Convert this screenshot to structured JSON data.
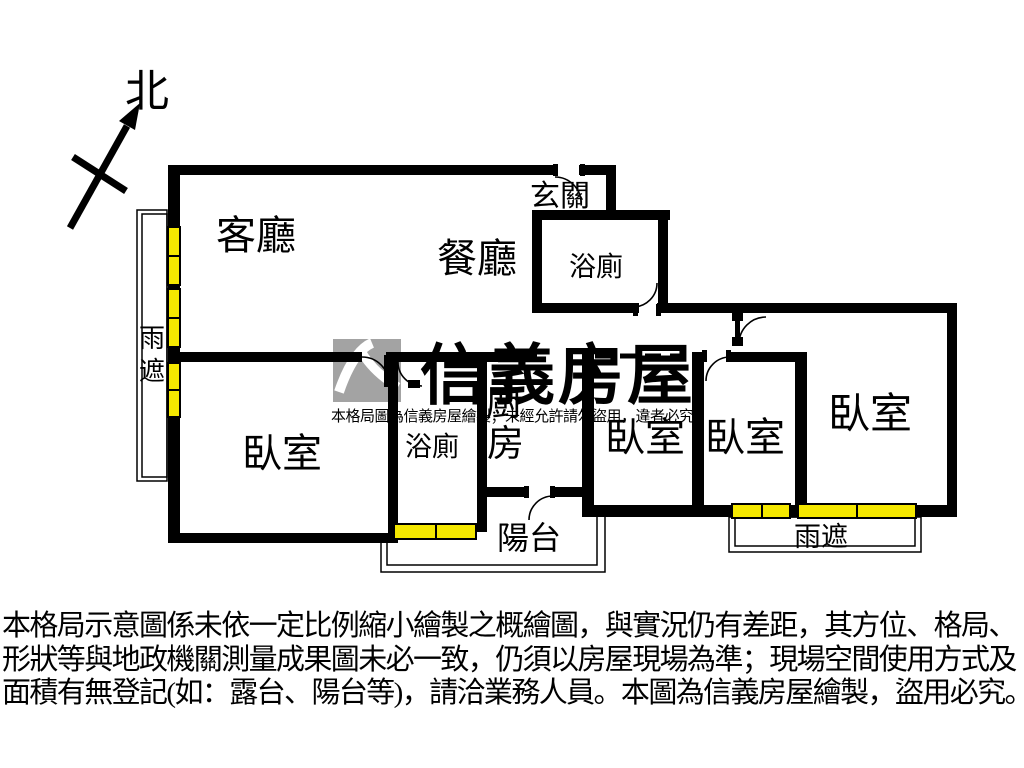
{
  "compass": {
    "north_label": "北"
  },
  "rooms": {
    "living": "客廳",
    "dining": "餐廳",
    "entry": "玄關",
    "bath_upper": "浴廁",
    "bath_lower": "浴廁",
    "kitchen_chars": [
      "廚",
      "房"
    ],
    "bedroom_left": "臥室",
    "bedroom_mid_left": "臥室",
    "bedroom_mid_right": "臥室",
    "bedroom_right": "臥室",
    "balcony": "陽台",
    "canopy_left_chars": [
      "雨",
      "遮"
    ],
    "canopy_bottom": "雨遮"
  },
  "watermark": {
    "brand": "信義房屋",
    "notice": "本格局圖為信義房屋繪製；未經允許請勿盜用，違者必究"
  },
  "disclaimer": {
    "line1": "本格局示意圖係未依一定比例縮小繪製之概繪圖，與實況仍有差距，其方位、格局、",
    "line2": "形狀等與地政機關測量成果圖未必一致，仍須以房屋現場為準；現場空間使用方式及",
    "line3": "面積有無登記(如：露台、陽台等)，請洽業務人員。本圖為信義房屋繪製，盜用必究。"
  },
  "colors": {
    "wall": "#000000",
    "window": "#f5e800",
    "watermark_text": "#b4b4b4",
    "logo_gray": "#a3a3a3"
  }
}
